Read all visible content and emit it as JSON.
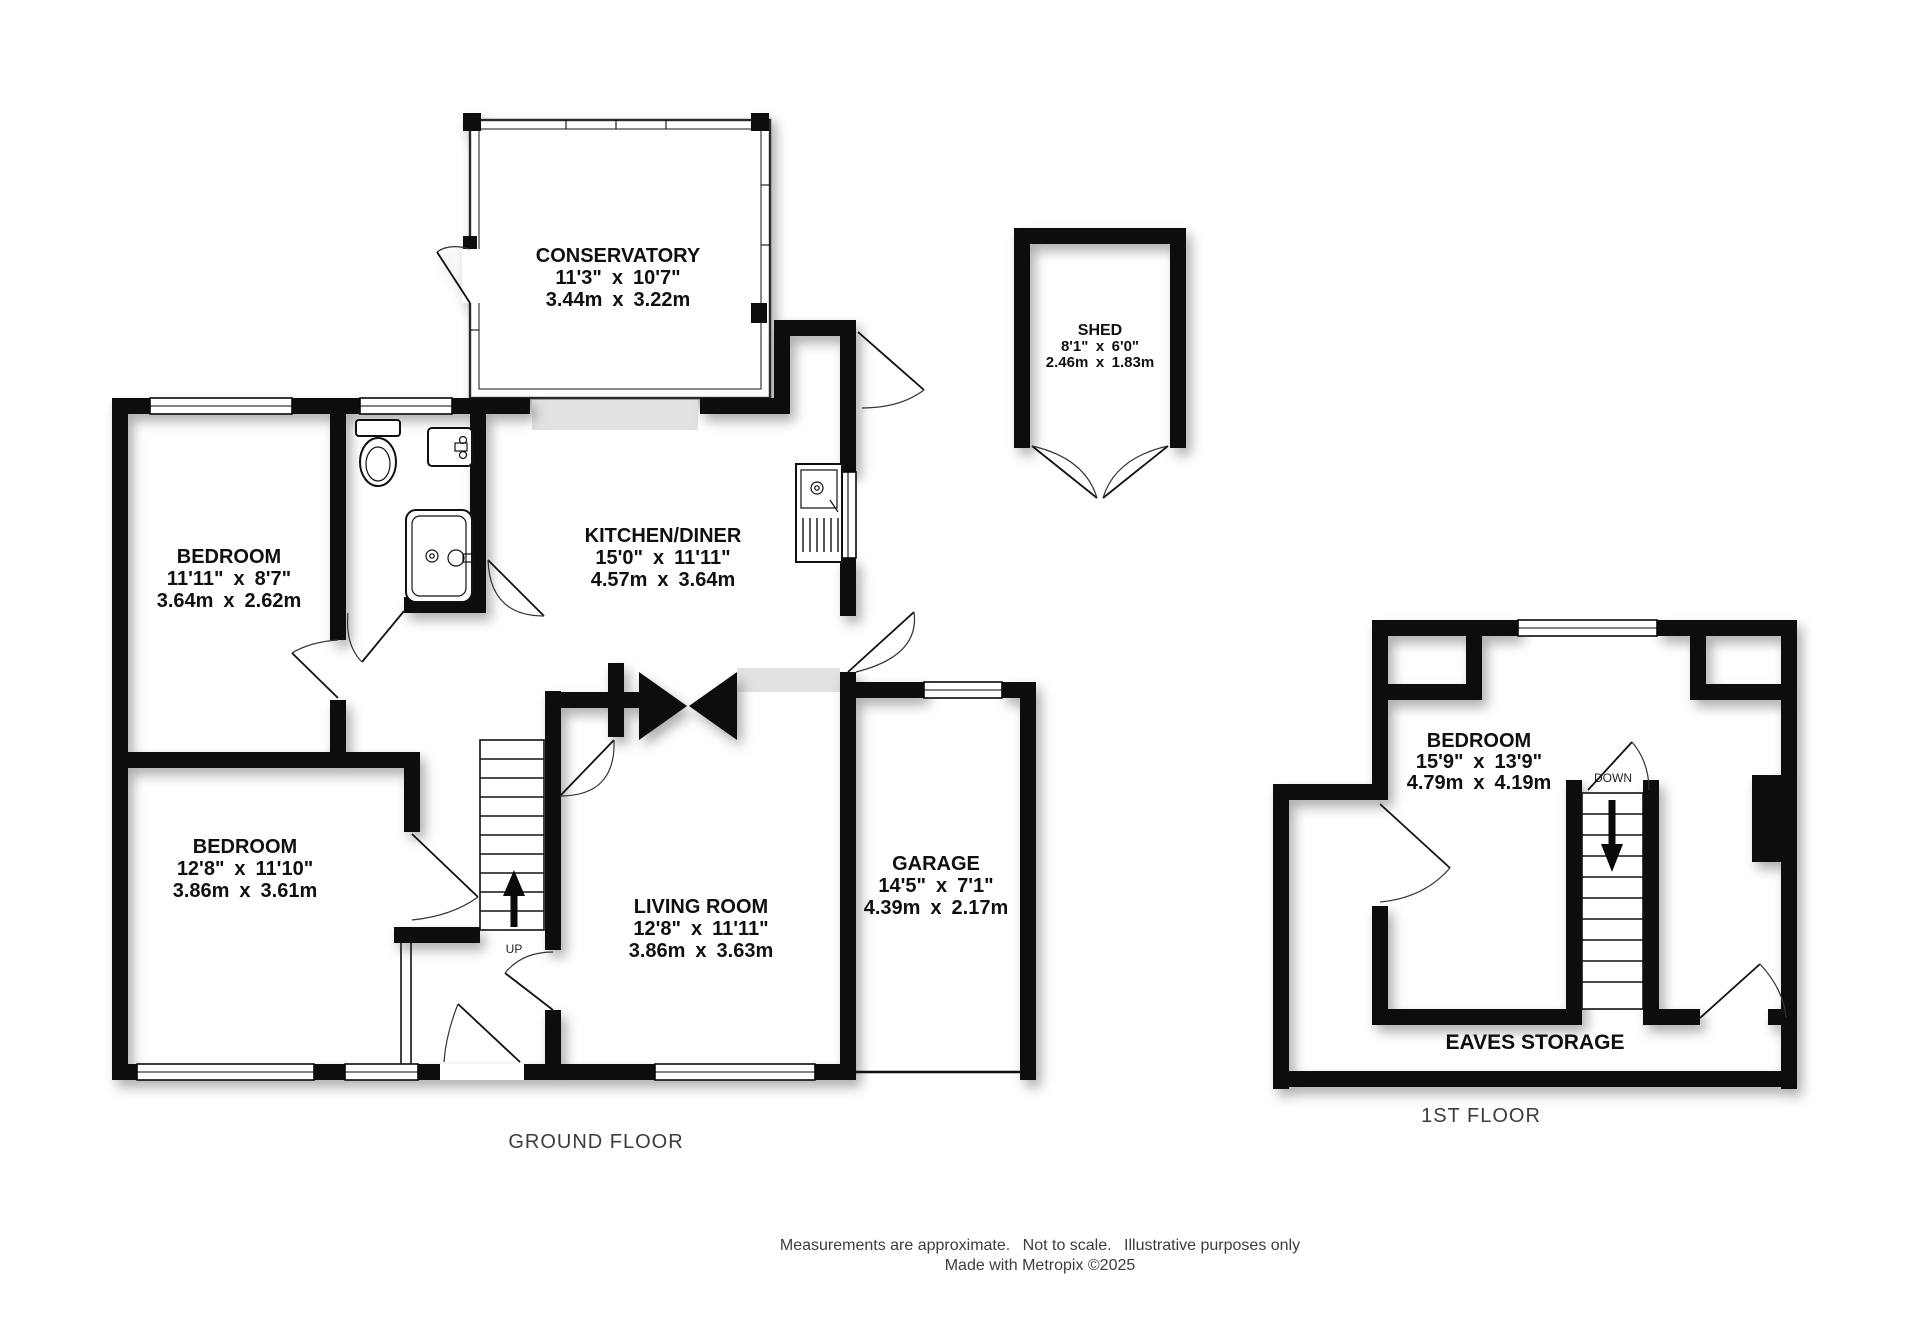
{
  "labels": {
    "ground_floor": "GROUND FLOOR",
    "first_floor": "1ST FLOOR"
  },
  "rooms": {
    "conservatory": {
      "name": "CONSERVATORY",
      "imperial": "11'3\" x 10'7\"",
      "metric": "3.44m x 3.22m"
    },
    "bedroom1": {
      "name": "BEDROOM",
      "imperial": "11'11\" x 8'7\"",
      "metric": "3.64m x 2.62m"
    },
    "kitchen": {
      "name": "KITCHEN/DINER",
      "imperial": "15'0\" x 11'11\"",
      "metric": "4.57m x 3.64m"
    },
    "bedroom2": {
      "name": "BEDROOM",
      "imperial": "12'8\" x 11'10\"",
      "metric": "3.86m x 3.61m"
    },
    "living": {
      "name": "LIVING ROOM",
      "imperial": "12'8\" x 11'11\"",
      "metric": "3.86m x 3.63m"
    },
    "garage": {
      "name": "GARAGE",
      "imperial": "14'5\" x 7'1\"",
      "metric": "4.39m x 2.17m"
    },
    "shed": {
      "name": "SHED",
      "imperial": "8'1\" x 6'0\"",
      "metric": "2.46m x 1.83m"
    },
    "bedroom_first": {
      "name": "BEDROOM",
      "imperial": "15'9\" x 13'9\"",
      "metric": "4.79m x 4.19m"
    },
    "eaves": {
      "name": "EAVES STORAGE"
    }
  },
  "stairs": {
    "up_label": "UP",
    "down_label": "DOWN"
  },
  "footer": {
    "line1": "Measurements are approximate.  Not to scale.  Illustrative purposes only",
    "line2": "Made with Metropix ©2025"
  },
  "colors": {
    "wall": "#0a0a0a",
    "floor": "#ffffff",
    "threshold": "#e2e2e2",
    "label_text": "#101010",
    "muted_text": "#3c3c3c"
  }
}
